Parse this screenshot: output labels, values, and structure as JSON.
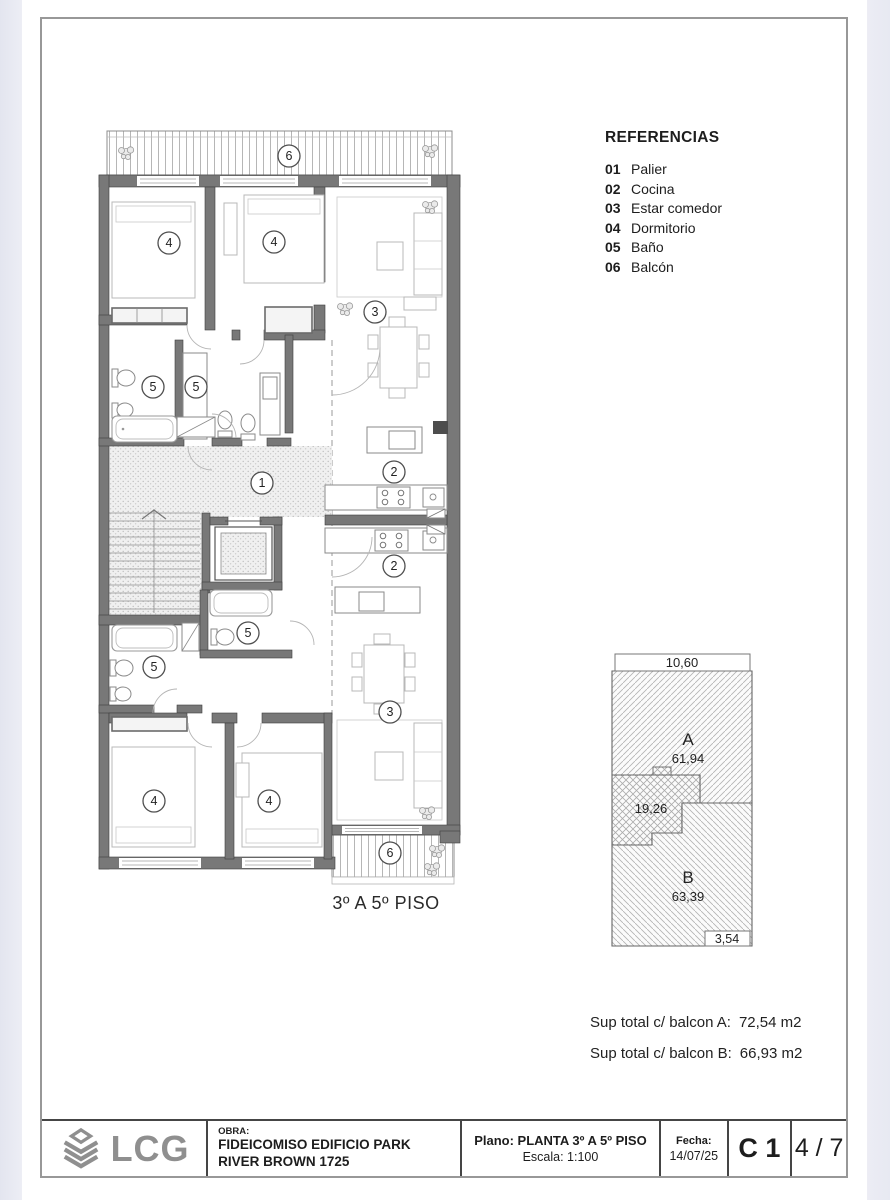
{
  "colors": {
    "wall_gray": "#787878",
    "paper_white": "#ffffff",
    "canvas_margin": "#e9eaf2",
    "titleblock_line": "#454545",
    "logo_gray": "#8f8f8f"
  },
  "plan": {
    "floor_caption": "3º A 5º PISO",
    "markers": [
      {
        "label": "6"
      },
      {
        "label": "4"
      },
      {
        "label": "4"
      },
      {
        "label": "3"
      },
      {
        "label": "5"
      },
      {
        "label": "5"
      },
      {
        "label": "1"
      },
      {
        "label": "2"
      },
      {
        "label": "2"
      },
      {
        "label": "5"
      },
      {
        "label": "5"
      },
      {
        "label": "3"
      },
      {
        "label": "4"
      },
      {
        "label": "4"
      },
      {
        "label": "6"
      }
    ]
  },
  "references": {
    "title": "REFERENCIAS",
    "items": [
      {
        "num": "01",
        "label": "Palier"
      },
      {
        "num": "02",
        "label": "Cocina"
      },
      {
        "num": "03",
        "label": "Estar comedor"
      },
      {
        "num": "04",
        "label": "Dormitorio"
      },
      {
        "num": "05",
        "label": "Baño"
      },
      {
        "num": "06",
        "label": "Balcón"
      }
    ]
  },
  "key_diagram": {
    "top_dimension": "10,60",
    "unit_a_label": "A",
    "unit_a_area": "61,94",
    "common_area": "19,26",
    "unit_b_label": "B",
    "unit_b_area": "63,39",
    "bottom_dimension": "3,54"
  },
  "totals": {
    "line_a_label": "Sup total c/ balcon A:",
    "line_a_value": "72,54 m2",
    "line_b_label": "Sup total c/ balcon B:",
    "line_b_value": "66,93 m2"
  },
  "title_block": {
    "logo_text": "LCG",
    "obra_label": "OBRA:",
    "obra_value": "FIDEICOMISO EDIFICIO PARK RIVER BROWN 1725",
    "plano_value": "Plano: PLANTA 3º A 5º PISO",
    "escala_value": "Escala: 1:100",
    "fecha_label": "Fecha:",
    "fecha_value": "14/07/25",
    "sheet_code": "C 1",
    "sheet_index": "4 / 7"
  }
}
